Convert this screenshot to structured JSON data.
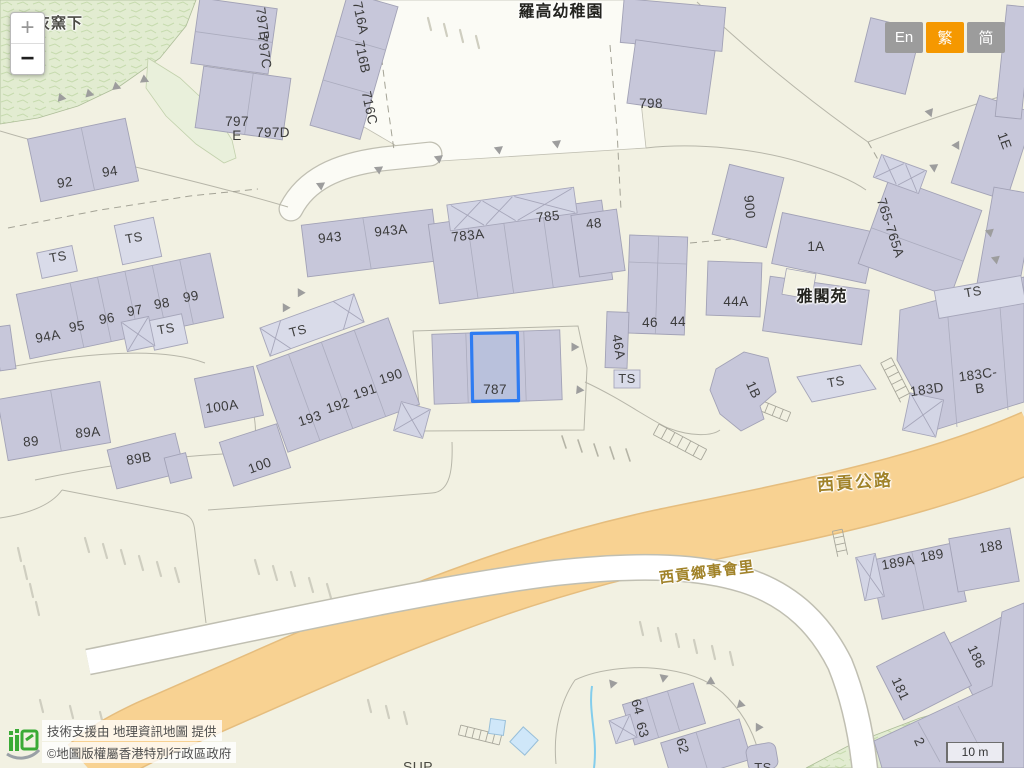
{
  "ui": {
    "zoom_in": "+",
    "zoom_out": "−",
    "languages": {
      "en": "En",
      "traditional": "繁",
      "simplified": "简"
    },
    "attribution": {
      "prefix": "技術支援由",
      "link": "地理資訊地圖",
      "suffix": "提供",
      "copyright": "©地圖版權屬香港特別行政區政府"
    },
    "scale_bar": "10 m"
  },
  "map": {
    "selected_lot": "787",
    "places": {
      "hill": "灰窯下",
      "kindergarten": "羅高幼稚園",
      "court": "雅閣苑"
    },
    "roads": {
      "sai_kung_highway": "西貢公路",
      "heung_sze_wui_lane": "西貢鄉事會里"
    },
    "ts_marker": "TS",
    "partial_text": "SUP",
    "lots": {
      "l92": "92",
      "l94": "94",
      "l94a": "94A",
      "l95": "95",
      "l96": "96",
      "l97": "97",
      "l98": "98",
      "l99": "99",
      "l89": "89",
      "l89a": "89A",
      "l89b": "89B",
      "l100a": "100A",
      "l100": "100",
      "l193": "193",
      "l192": "192",
      "l191": "191",
      "l190": "190",
      "l943": "943",
      "l943a": "943A",
      "l783a": "783A",
      "l785": "785",
      "l48": "48",
      "l787": "787",
      "l797b": "797B",
      "l797c": "797C",
      "l797e": "797\nE",
      "l797d": "797D",
      "l716a": "716A",
      "l716b": "716B",
      "l716c": "716C",
      "l798": "798",
      "l1e": "1E",
      "l900": "900",
      "l1a": "1A",
      "l44a": "44A",
      "l46": "46",
      "l44": "44",
      "l765": "765-765A",
      "l46a": "46A",
      "l1b": "1B",
      "l183d": "183D",
      "l183cb": "183C-B",
      "l189a": "189A",
      "l189": "189",
      "l188": "188",
      "l186": "186",
      "l181": "181",
      "l2": "2",
      "l64": "64",
      "l63": "63",
      "l62": "62"
    }
  },
  "colors": {
    "selected_outline": "#2e7cf2",
    "building_fill": "#c7c7da",
    "highway_fill": "#f8d292",
    "language_active": "#f59800",
    "road_label": "#a1832a"
  }
}
